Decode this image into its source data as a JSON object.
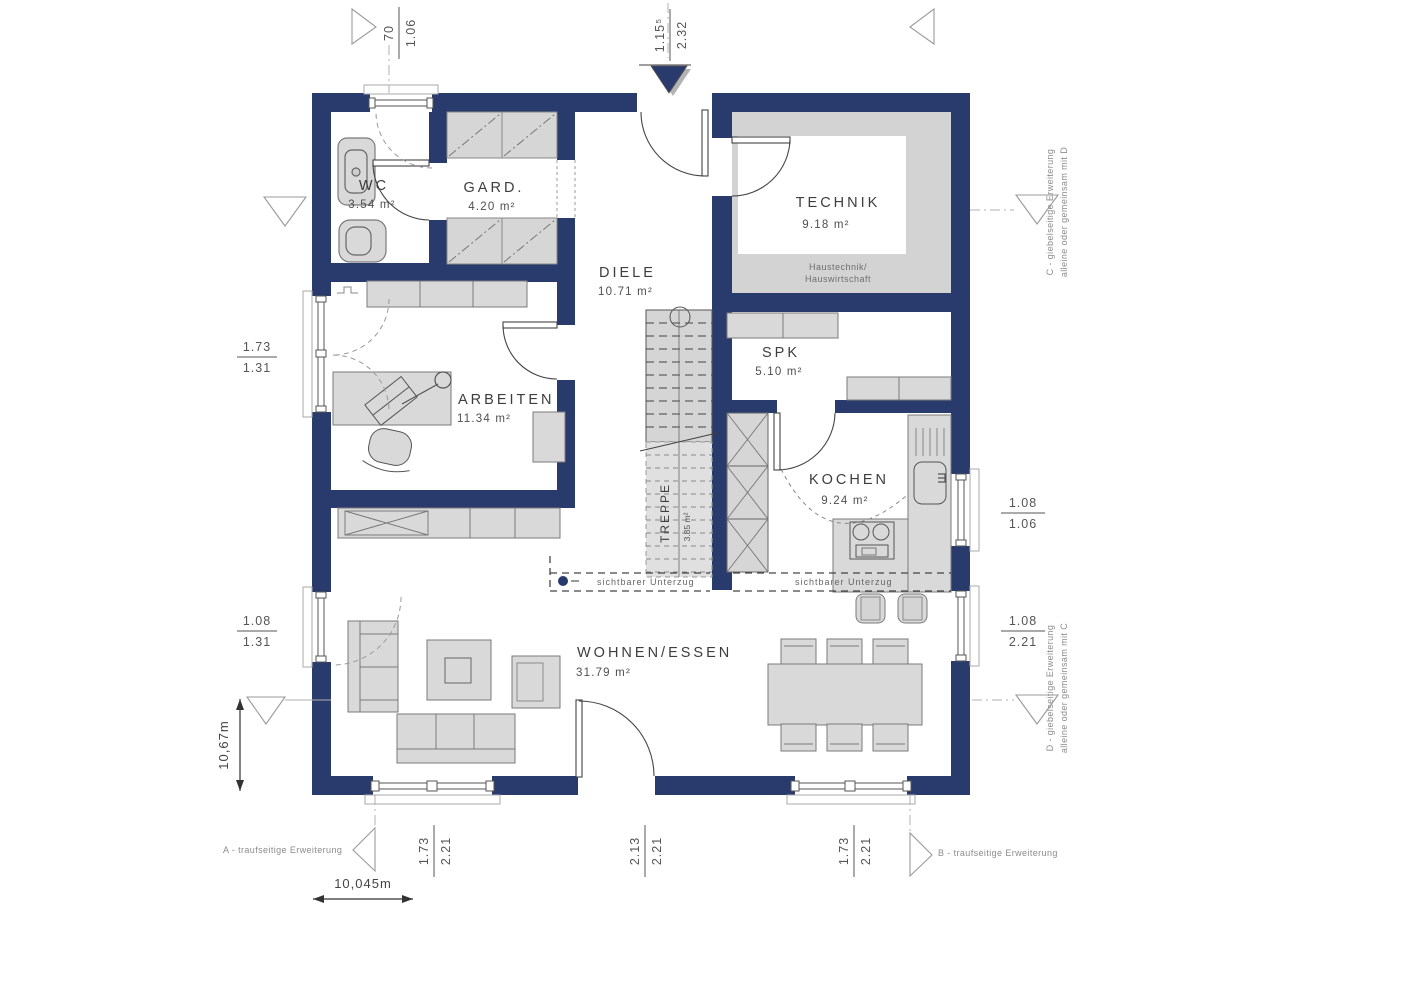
{
  "colors": {
    "wall": "#293a6d",
    "furniture_fill": "#d9d9d9",
    "furniture_stroke": "#7a7a7a",
    "floor_shade": "#d3d3d3",
    "accent_dot": "#293a6d"
  },
  "rooms": {
    "wc": {
      "name": "WC",
      "area": "3.54 m²"
    },
    "gard": {
      "name": "GARD.",
      "area": "4.20 m²"
    },
    "technik": {
      "name": "TECHNIK",
      "area": "9.18 m²",
      "note_line1": "Haustechnik/",
      "note_line2": "Hauswirtschaft"
    },
    "diele": {
      "name": "DIELE",
      "area": "10.71 m²"
    },
    "spk": {
      "name": "SPK",
      "area": "5.10 m²"
    },
    "arbeiten": {
      "name": "ARBEITEN",
      "area": "11.34 m²"
    },
    "kochen": {
      "name": "KOCHEN",
      "area": "9.24 m²"
    },
    "treppe": {
      "name": "TREPPE",
      "area": "3.85 m²"
    },
    "wohnen": {
      "name": "WOHNEN/ESSEN",
      "area": "31.79 m²"
    }
  },
  "beam": {
    "left": "sichtbarer Unterzug",
    "right": "sichtbarer Unterzug"
  },
  "dims": {
    "top_left": {
      "num": "70",
      "den": "1.06"
    },
    "top_center": {
      "num": "1.15⁵",
      "den": "2.32"
    },
    "left_upper": {
      "num": "1.73",
      "den": "1.31"
    },
    "left_lower": {
      "num": "1.08",
      "den": "1.31"
    },
    "right_upper": {
      "num": "1.08",
      "den": "1.06"
    },
    "right_lower": {
      "num": "1.08",
      "den": "2.21"
    },
    "bottom_left": {
      "num": "1.73",
      "den": "2.21"
    },
    "bottom_center": {
      "num": "2.13",
      "den": "2.21"
    },
    "bottom_right": {
      "num": "1.73",
      "den": "2.21"
    },
    "total_width": "10,045m",
    "total_height": "10,67m"
  },
  "extensions": {
    "a": "A - traufseitige Erweiterung",
    "b": "B - traufseitige Erweiterung",
    "c_line1": "C - giebelseitige Erweiterung",
    "c_line2": "alleine oder gemeinsam mit D",
    "d_line1": "D - giebelseitige Erweiterung",
    "d_line2": "alleine oder gemeinsam mit C"
  }
}
